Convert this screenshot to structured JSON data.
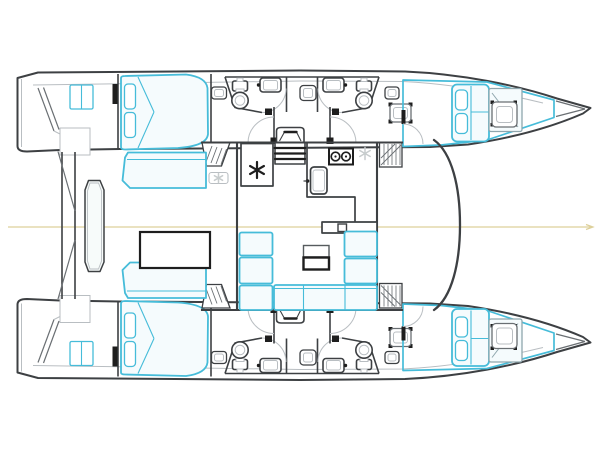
{
  "diagram": {
    "type": "catamaran-floor-plan",
    "view": "top-down-deck-layout",
    "visible_text": []
  },
  "colors": {
    "background": "#ffffff",
    "hull_outline": "#3d4043",
    "detail_dark": "#1e1e1e",
    "detail_mid": "#6a6f73",
    "detail_light": "#b9bec2",
    "furniture_blue": "#46bcd9",
    "furniture_fill": "#f5fbfd",
    "faint_icon": "#c7cccd",
    "centerline_yellow": "#ddd09a"
  },
  "features": {
    "hulls": 2,
    "double_beds": 4,
    "bathrooms": 4,
    "toilets": 4,
    "bathroom_sinks": 4,
    "staircases": 2,
    "galley_stove_burners": 2,
    "snowflake_icons": 3,
    "salon_table": 1,
    "cockpit_table": 1,
    "deck_hatches": 4,
    "portholes": 4,
    "center_hatches": 2
  }
}
